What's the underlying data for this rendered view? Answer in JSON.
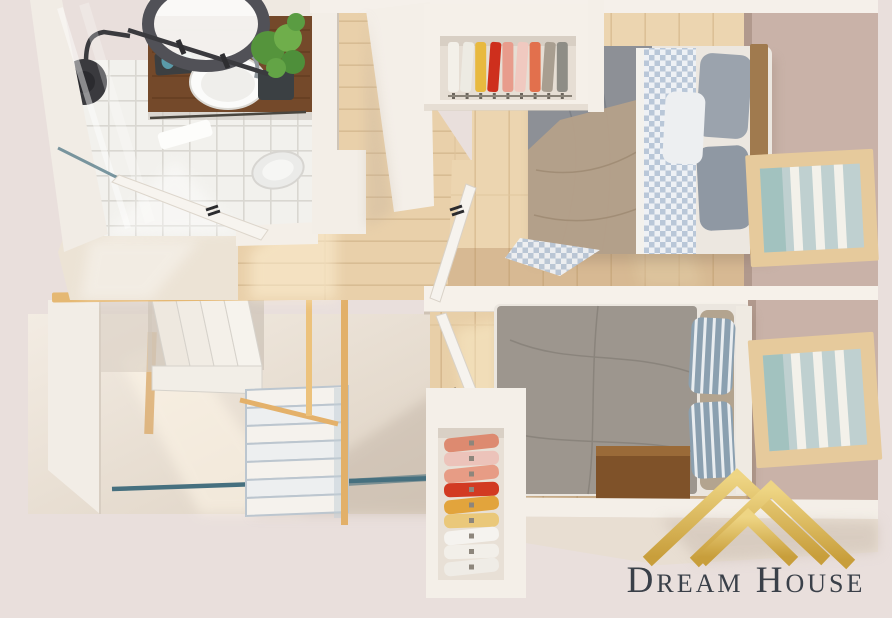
{
  "scene": {
    "description_visible_text_only": true,
    "background": "#e9dfdc"
  },
  "logo": {
    "text": "Dream House",
    "text_color": "#3a4049",
    "gold_light": "#eed584",
    "gold_dark": "#c89e3b"
  },
  "palette": {
    "wall_light": "#f4efe8",
    "wall_shadow": "#d9cec4",
    "wall_taupe": "#c9b2a8",
    "wood_floor": "#ead1ab",
    "tile": "#f2f1ed",
    "vanity_wood": "#74492a",
    "rail_gold": "#e5b873",
    "teal_glass": "#46707f",
    "bed1_gray": "#8d9096",
    "bed1_tan": "#b5a089",
    "bed2_duvet": "#9d968e",
    "nightstand_wood": "#7f5229",
    "plant_green": "#55943c",
    "window_frame": "#e6ca9c",
    "window_glass": "#bfd0d0",
    "mirror_ring": "#515157",
    "shower_black": "#3a3a3e"
  },
  "closet_top": {
    "items": [
      "#f3f0e9",
      "#edebe3",
      "#e8b93f",
      "#ce2f1d",
      "#e89c8c",
      "#f0c9c0",
      "#e2704d",
      "#a89e90",
      "#8e8d86"
    ]
  },
  "closet_bottom": {
    "items": [
      "#dd8a70",
      "#ecc3ba",
      "#e79c85",
      "#d23a22",
      "#e2a43c",
      "#eac87a",
      "#f5f3ef",
      "#f2efe9",
      "#efece6"
    ]
  }
}
